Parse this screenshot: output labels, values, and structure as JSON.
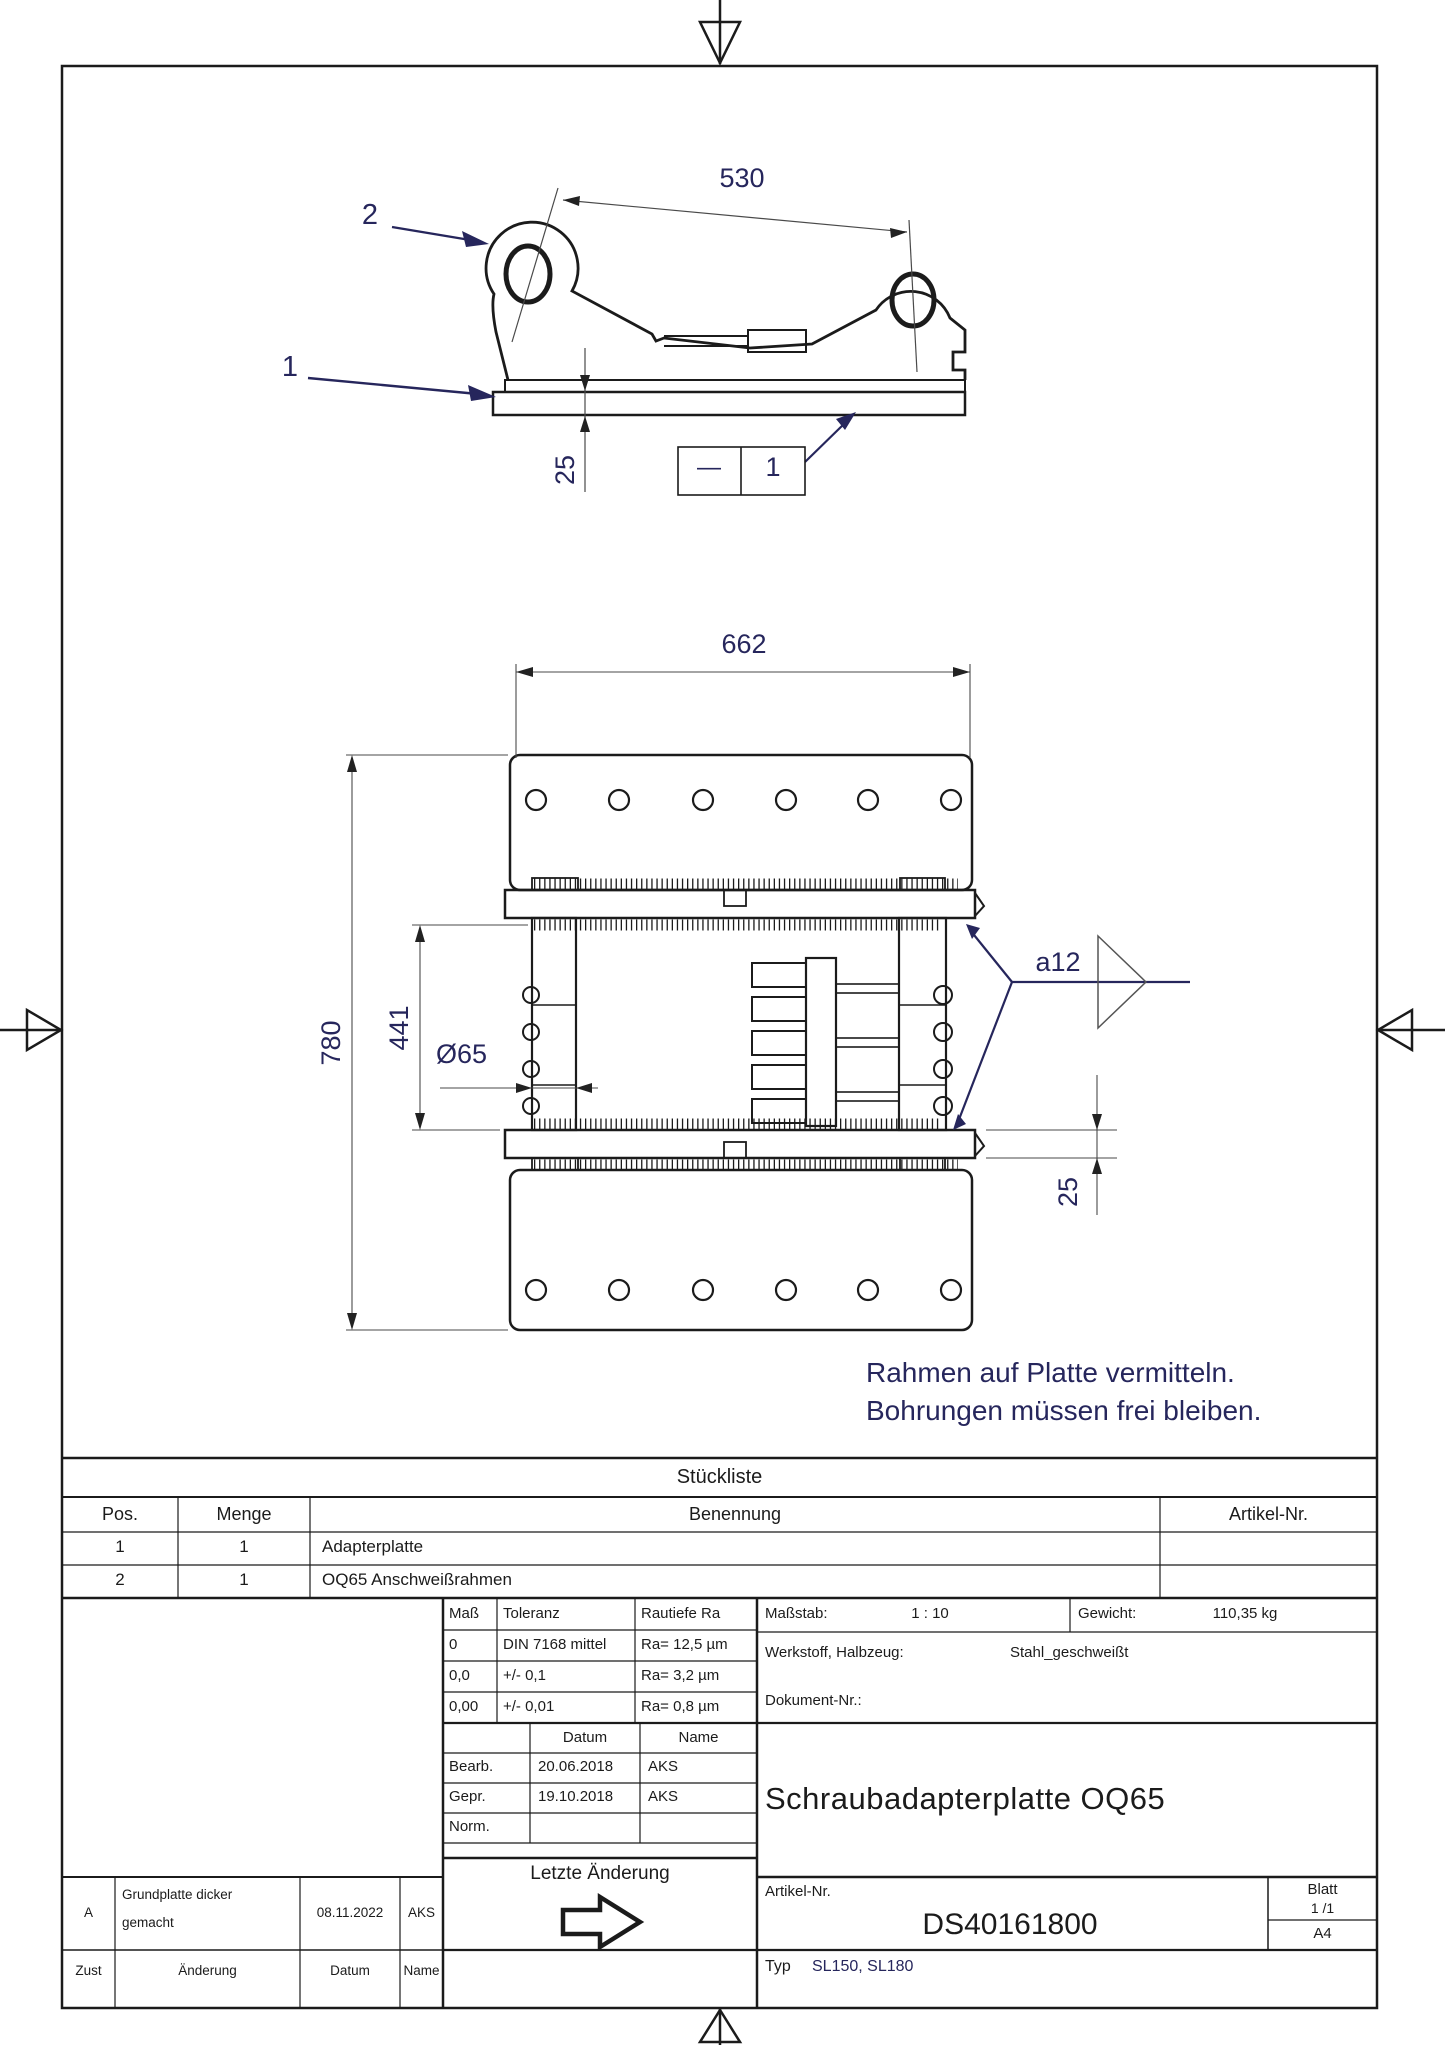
{
  "top_view": {
    "balloon_2": "2",
    "balloon_1": "1",
    "dim_530": "530",
    "dim_25": "25",
    "weld_dash": "—",
    "weld_num": "1"
  },
  "plan_view": {
    "dim_662": "662",
    "dim_780": "780",
    "dim_441": "441",
    "dim_d65": "Ø65",
    "dim_25": "25",
    "weld_a12": "a12"
  },
  "note": {
    "line1": "Rahmen auf Platte vermitteln.",
    "line2": "Bohrungen müssen frei bleiben."
  },
  "parts_list": {
    "title": "Stückliste",
    "headers": {
      "pos": "Pos.",
      "menge": "Menge",
      "benennung": "Benennung",
      "artikel": "Artikel-Nr."
    },
    "rows": [
      {
        "pos": "1",
        "menge": "1",
        "benennung": "Adapterplatte",
        "artikel": ""
      },
      {
        "pos": "2",
        "menge": "1",
        "benennung": "OQ65 Anschweißrahmen",
        "artikel": ""
      }
    ]
  },
  "tolerance_table": {
    "headers": {
      "mass": "Maß",
      "toleranz": "Toleranz",
      "rautiefe": "Rautiefe Ra"
    },
    "rows": [
      {
        "mass": "0",
        "toleranz": "DIN 7168 mittel",
        "rautiefe": "Ra= 12,5 µm"
      },
      {
        "mass": "0,0",
        "toleranz": "+/- 0,1",
        "rautiefe": "Ra= 3,2 µm"
      },
      {
        "mass": "0,00",
        "toleranz": "+/- 0,01",
        "rautiefe": "Ra= 0,8 µm"
      }
    ]
  },
  "info": {
    "massstab_label": "Maßstab:",
    "massstab_value": "1 : 10",
    "gewicht_label": "Gewicht:",
    "gewicht_value": "110,35 kg",
    "werkstoff_label": "Werkstoff, Halbzeug:",
    "werkstoff_value": "Stahl_geschweißt",
    "dokument_label": "Dokument-Nr.:"
  },
  "sign_table": {
    "datum_header": "Datum",
    "name_header": "Name",
    "rows": [
      {
        "label": "Bearb.",
        "datum": "20.06.2018",
        "name": "AKS"
      },
      {
        "label": "Gepr.",
        "datum": "19.10.2018",
        "name": "AKS"
      },
      {
        "label": "Norm.",
        "datum": "",
        "name": ""
      }
    ]
  },
  "title_block": {
    "title": "Schraubadapterplatte OQ65",
    "artikel_label": "Artikel-Nr.",
    "artikel_value": "DS40161800",
    "blatt_label": "Blatt",
    "blatt_value": "1 /1",
    "format": "A4",
    "typ_label": "Typ",
    "typ_value": "SL150, SL180",
    "letzte_aenderung": "Letzte Änderung"
  },
  "revision_table": {
    "row": {
      "zust": "A",
      "aenderung_line1": "Grundplatte dicker",
      "aenderung_line2": "gemacht",
      "datum": "08.11.2022",
      "name": "AKS"
    },
    "headers": {
      "zust": "Zust",
      "aenderung": "Änderung",
      "datum": "Datum",
      "name": "Name"
    }
  },
  "colors": {
    "annotation": "#26265c",
    "line": "#1b1b1b",
    "dim_line": "#4a4a4a"
  }
}
